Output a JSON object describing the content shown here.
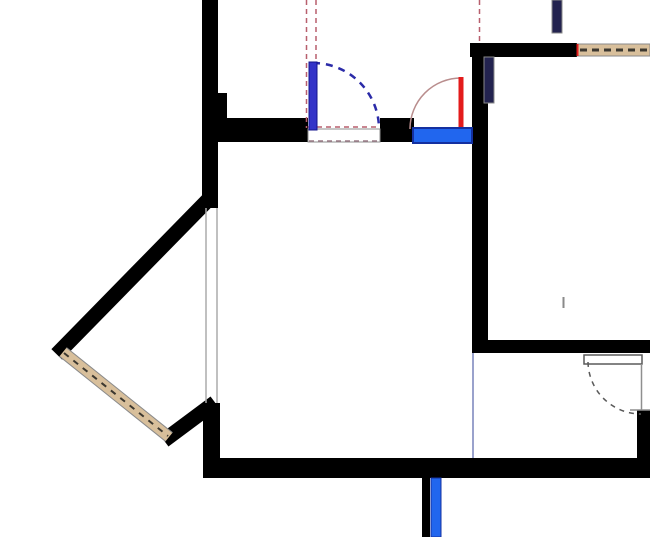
{
  "canvas": {
    "width": 650,
    "height": 537,
    "background": "#ffffff"
  },
  "colors": {
    "wall": "#000000",
    "tan": "#d8bf9b",
    "tanDash": "#3c3830",
    "grayOutline": "#8a8a8a",
    "lightGray": "#ababab",
    "rose": "#b85f6d",
    "roseGray": "#9a7a86",
    "red": "#e31b1b",
    "roseArc": "#b98d8d",
    "blue": "#2166ee",
    "blueDark": "#1430a0",
    "doorBlue": "#3434c8",
    "doorBlueEdge": "#14148c",
    "navyArc": "#2b2ba8",
    "navyBar": "#23234f",
    "lavender": "#9aa2cc",
    "doorGray": "#5a5a5a",
    "frameGray": "#8f8f8f",
    "white": "#ffffff"
  },
  "elements": [
    {
      "name": "wall-left-upper",
      "type": "rect",
      "x": 202,
      "y": 0,
      "w": 16,
      "h": 208,
      "fill": "wall"
    },
    {
      "name": "wall-left-notch",
      "type": "rect",
      "x": 218,
      "y": 93,
      "w": 9,
      "h": 25,
      "fill": "wall"
    },
    {
      "name": "wall-top-main-left",
      "type": "rect",
      "x": 202,
      "y": 118,
      "w": 106,
      "h": 24,
      "fill": "wall"
    },
    {
      "name": "wall-top-main-mid",
      "type": "rect",
      "x": 380,
      "y": 118,
      "w": 34,
      "h": 24,
      "fill": "wall"
    },
    {
      "name": "wall-right-vertical",
      "type": "rect",
      "x": 472,
      "y": 43,
      "w": 16,
      "h": 297,
      "fill": "wall"
    },
    {
      "name": "wall-topright-horizontal",
      "type": "rect",
      "x": 470,
      "y": 43,
      "w": 107,
      "h": 14,
      "fill": "wall"
    },
    {
      "name": "wall-midright-horizontal",
      "type": "rect",
      "x": 472,
      "y": 340,
      "w": 178,
      "h": 13,
      "fill": "wall"
    },
    {
      "name": "wall-bottom",
      "type": "rect",
      "x": 203,
      "y": 458,
      "w": 447,
      "h": 20,
      "fill": "wall"
    },
    {
      "name": "wall-left-lower",
      "type": "rect",
      "x": 203,
      "y": 403,
      "w": 17,
      "h": 62,
      "fill": "wall"
    },
    {
      "name": "wall-bay-upper-diagonal",
      "type": "line",
      "x1": 206,
      "y1": 202,
      "x2": 62,
      "y2": 349,
      "stroke": "wall",
      "sw": 15,
      "cap": "square"
    },
    {
      "name": "wall-bay-lower-diagonal",
      "type": "line",
      "x1": 170,
      "y1": 436,
      "x2": 209,
      "y2": 407,
      "stroke": "wall",
      "sw": 15,
      "cap": "square"
    },
    {
      "name": "wall-bottomright-stub",
      "type": "rect",
      "x": 637,
      "y": 410,
      "w": 13,
      "h": 48,
      "fill": "wall"
    },
    {
      "name": "wall-bottom-stub-below",
      "type": "rect",
      "x": 422,
      "y": 478,
      "w": 8,
      "h": 59,
      "fill": "wall"
    },
    {
      "name": "window-tan-topright",
      "type": "rect",
      "x": 577,
      "y": 44,
      "w": 73,
      "h": 12,
      "fill": "tan",
      "stroke": "grayOutline",
      "sw": 1
    },
    {
      "name": "window-tan-topright-dashes",
      "type": "line",
      "x1": 580,
      "y1": 50,
      "x2": 650,
      "y2": 50,
      "stroke": "tanDash",
      "sw": 3,
      "dash": "7 5"
    },
    {
      "name": "window-tan-topright-redtick",
      "type": "line",
      "x1": 577.5,
      "y1": 44,
      "x2": 577.5,
      "y2": 56,
      "stroke": "red",
      "sw": 2
    },
    {
      "name": "bay-window-fill",
      "type": "line",
      "x1": 63,
      "y1": 352,
      "x2": 169,
      "y2": 437,
      "stroke": "tan",
      "sw": 11
    },
    {
      "name": "bay-window-edge-outer",
      "type": "line",
      "x1": 59.5,
      "y1": 356.3,
      "x2": 165.5,
      "y2": 441.3,
      "stroke": "grayOutline",
      "sw": 1
    },
    {
      "name": "bay-window-edge-inner",
      "type": "line",
      "x1": 66.5,
      "y1": 347.7,
      "x2": 172.5,
      "y2": 432.7,
      "stroke": "grayOutline",
      "sw": 1
    },
    {
      "name": "bay-window-dashes",
      "type": "line",
      "x1": 64,
      "y1": 353,
      "x2": 168,
      "y2": 436,
      "stroke": "tanDash",
      "sw": 2,
      "dash": "6 6"
    },
    {
      "name": "bay-opening-line-outer",
      "type": "line",
      "x1": 206,
      "y1": 208,
      "x2": 206,
      "y2": 403,
      "stroke": "lightGray",
      "sw": 1.5
    },
    {
      "name": "bay-opening-line-inner",
      "type": "line",
      "x1": 217,
      "y1": 208,
      "x2": 217,
      "y2": 403,
      "stroke": "lightGray",
      "sw": 1.5
    },
    {
      "name": "room-divider-line",
      "type": "line",
      "x1": 473,
      "y1": 353,
      "x2": 473,
      "y2": 458,
      "stroke": "lavender",
      "sw": 2
    },
    {
      "name": "wall-tick-mark",
      "type": "line",
      "x1": 563.5,
      "y1": 297,
      "x2": 563.5,
      "y2": 308,
      "stroke": "grayOutline",
      "sw": 2
    },
    {
      "name": "door-threshold-top",
      "type": "rect",
      "x": 308,
      "y": 129,
      "w": 72,
      "h": 13,
      "fill": "white",
      "stroke": "frameGray",
      "sw": 1
    },
    {
      "name": "door-threshold-top-dashes",
      "type": "line",
      "x1": 309,
      "y1": 141,
      "x2": 379,
      "y2": 141,
      "stroke": "roseGray",
      "sw": 1.5,
      "dash": "5 4"
    },
    {
      "name": "projection-dashed-threshold",
      "type": "line",
      "x1": 308,
      "y1": 127,
      "x2": 380,
      "y2": 127,
      "stroke": "rose",
      "sw": 1.5,
      "dash": "5 4"
    },
    {
      "name": "projection-dashed-left",
      "type": "line",
      "x1": 306.5,
      "y1": 0,
      "x2": 306.5,
      "y2": 128,
      "stroke": "rose",
      "sw": 1.5,
      "dash": "5 4"
    },
    {
      "name": "projection-dashed-right",
      "type": "line",
      "x1": 316,
      "y1": 0,
      "x2": 316,
      "y2": 128,
      "stroke": "rose",
      "sw": 1.5,
      "dash": "5 4"
    },
    {
      "name": "projection-dashed-topright",
      "type": "line",
      "x1": 479.5,
      "y1": 0,
      "x2": 479.5,
      "y2": 44,
      "stroke": "rose",
      "sw": 1.5,
      "dash": "5 4"
    },
    {
      "name": "door-blue-swing-arc",
      "type": "path",
      "d": "M 313 63 A 66 66 0 0 1 379 129",
      "stroke": "navyArc",
      "sw": 2.5,
      "dash": "7 6",
      "fill": "none"
    },
    {
      "name": "door-blue-leaf",
      "type": "rect",
      "x": 309,
      "y": 62,
      "w": 8,
      "h": 68,
      "fill": "doorBlue",
      "stroke": "doorBlueEdge",
      "sw": 1
    },
    {
      "name": "door-red-swing-arc",
      "type": "path",
      "d": "M 410 129 A 51 51 0 0 1 461 78",
      "stroke": "roseArc",
      "sw": 1.5,
      "fill": "none"
    },
    {
      "name": "door-red-leaf",
      "type": "rect",
      "x": 458.5,
      "y": 77,
      "w": 5,
      "h": 52,
      "fill": "red"
    },
    {
      "name": "window-blue-top",
      "type": "rect",
      "x": 413,
      "y": 128,
      "w": 59,
      "h": 15,
      "fill": "blue",
      "stroke": "blueDark",
      "sw": 2
    },
    {
      "name": "door-panel-navy-top",
      "type": "rect",
      "x": 552,
      "y": 0,
      "w": 10,
      "h": 33,
      "fill": "navyBar",
      "stroke": "grayOutline",
      "sw": 1
    },
    {
      "name": "door-panel-navy-right",
      "type": "rect",
      "x": 484,
      "y": 57,
      "w": 10,
      "h": 46,
      "fill": "navyBar",
      "stroke": "grayOutline",
      "sw": 1
    },
    {
      "name": "door-bottomright-leaf",
      "type": "rect",
      "x": 584,
      "y": 355,
      "w": 58,
      "h": 9,
      "fill": "white",
      "stroke": "doorGray",
      "sw": 1.5
    },
    {
      "name": "door-bottomright-swing-arc",
      "type": "path",
      "d": "M 588 362 A 53 53 0 0 0 641 414",
      "stroke": "doorGray",
      "sw": 1.5,
      "dash": "5 5",
      "fill": "none"
    },
    {
      "name": "door-bottomright-frame",
      "type": "line",
      "x1": 641.5,
      "y1": 364,
      "x2": 641.5,
      "y2": 410,
      "stroke": "frameGray",
      "sw": 1.5
    },
    {
      "name": "door-bottomright-stub-line",
      "type": "line",
      "x1": 630,
      "y1": 410,
      "x2": 650,
      "y2": 410,
      "stroke": "frameGray",
      "sw": 1.5
    },
    {
      "name": "window-blue-bottom-stub",
      "type": "rect",
      "x": 431,
      "y": 478,
      "w": 10,
      "h": 59,
      "fill": "blue",
      "stroke": "blueDark",
      "sw": 1
    }
  ]
}
